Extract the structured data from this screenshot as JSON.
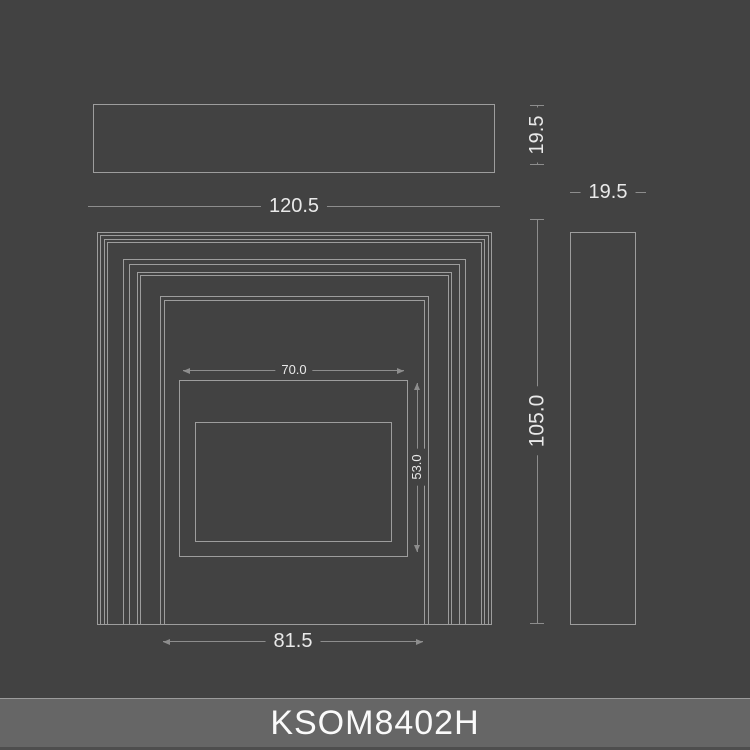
{
  "product": {
    "code": "KSOM8402H"
  },
  "dimensions": {
    "front_width": "120.5",
    "front_height": "105.0",
    "opening_width": "81.5",
    "inner_width": "70.0",
    "inner_height": "53.0",
    "top_view_depth": "19.5",
    "side_view_depth": "19.5"
  },
  "colors": {
    "background": "#424242",
    "line": "#9d9d9d",
    "dim_line": "#8d8d8d",
    "text": "#e9e9e9",
    "bar_bg": "#666666",
    "bar_text": "#fafafa",
    "bar_top": "#9c9c9c",
    "bar_bottom": "#4e4e4e"
  }
}
